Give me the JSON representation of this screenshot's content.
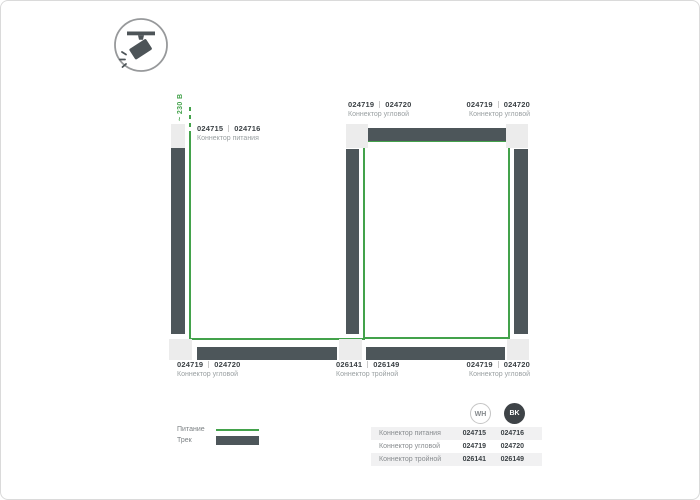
{
  "icon": {
    "name": "track-spotlight"
  },
  "diagram": {
    "dimension_label": "~ 230 В",
    "labels": {
      "power": {
        "code_wh": "024715",
        "code_bk": "024716",
        "name": "Коннектор питания"
      },
      "corner_top_left": {
        "code_wh": "024719",
        "code_bk": "024720",
        "name": "Коннектор угловой"
      },
      "corner_top_right": {
        "code_wh": "024719",
        "code_bk": "024720",
        "name": "Коннектор угловой"
      },
      "corner_bottom_left": {
        "code_wh": "024719",
        "code_bk": "024720",
        "name": "Коннектор угловой"
      },
      "triple_bottom": {
        "code_wh": "026141",
        "code_bk": "026149",
        "name": "Коннектор тройной"
      },
      "corner_bottom_right": {
        "code_wh": "024719",
        "code_bk": "024720",
        "name": "Коннектор угловой"
      }
    }
  },
  "legend": {
    "power": "Питание",
    "track": "Трек"
  },
  "table": {
    "columns": {
      "wh": "WH",
      "bk": "BK"
    },
    "rows": [
      {
        "name": "Коннектор питания",
        "wh": "024715",
        "bk": "024716"
      },
      {
        "name": "Коннектор угловой",
        "wh": "024719",
        "bk": "024720"
      },
      {
        "name": "Коннектор тройной",
        "wh": "026141",
        "bk": "026149"
      }
    ]
  },
  "colors": {
    "accent_green": "#43a24b",
    "track_dark": "#4d565a",
    "connector_light": "#ececec",
    "circle_bk": "#3e4347"
  }
}
